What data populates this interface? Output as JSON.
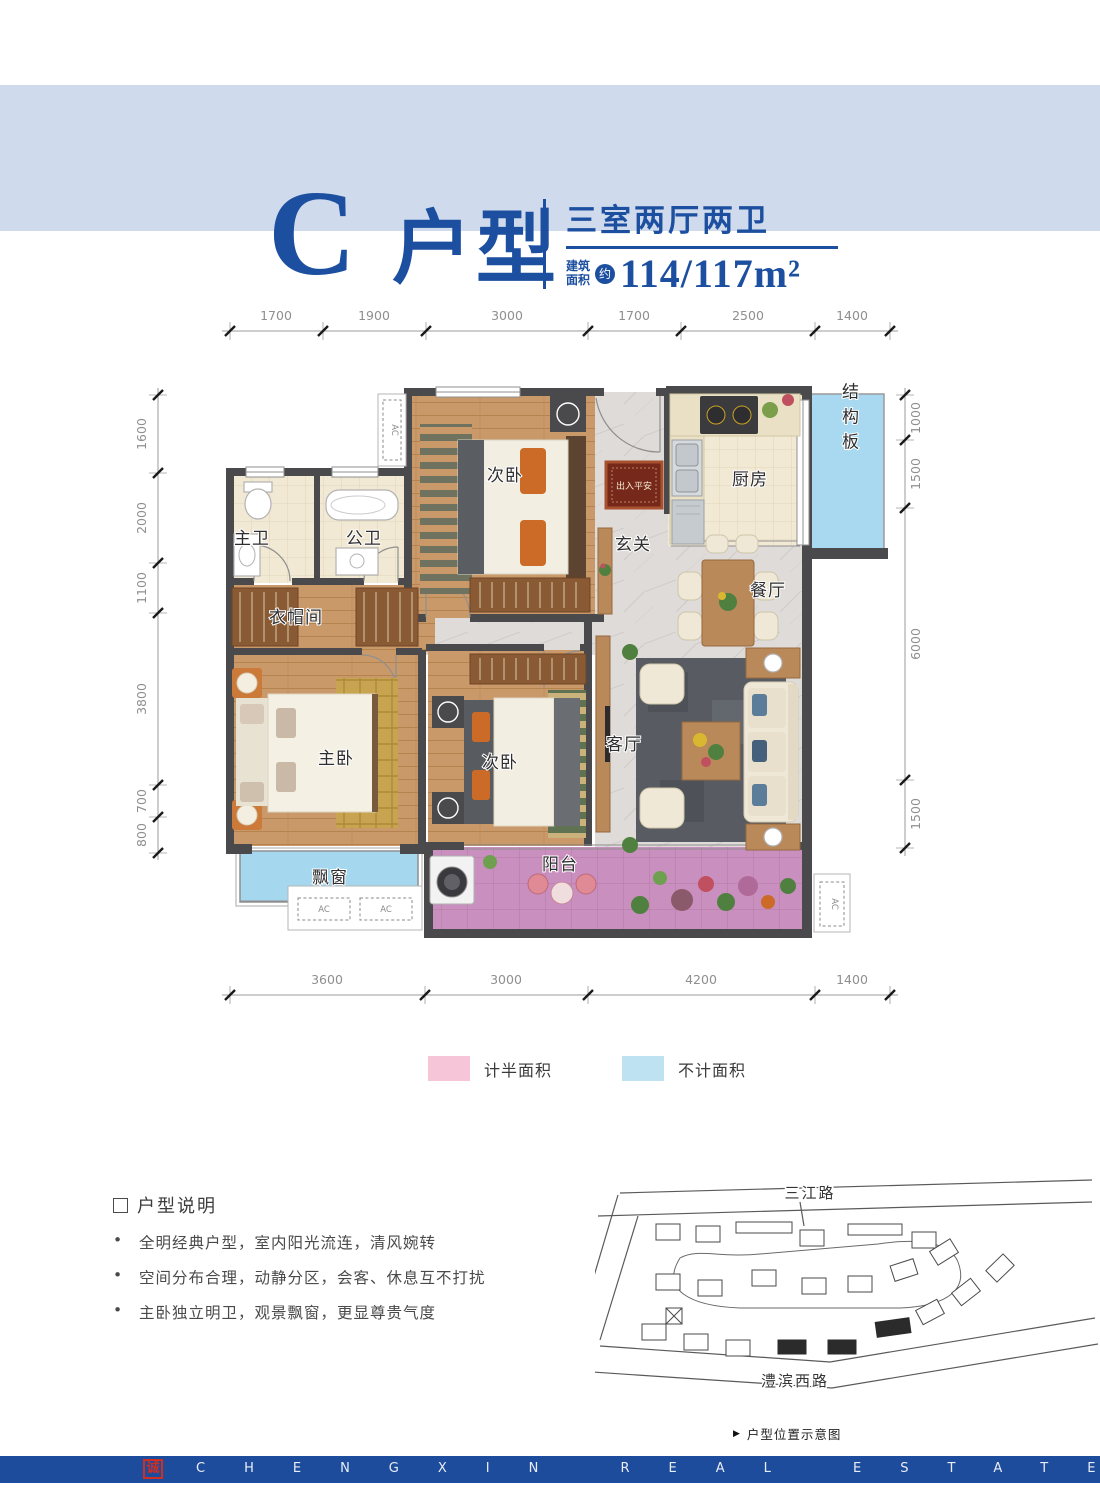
{
  "header": {
    "type_letter": "C",
    "type_name": "户型",
    "rooms_title": "三室两厅两卫",
    "area_label_line1": "建筑",
    "area_label_line2": "面积",
    "area_approx": "约",
    "area_value": "114/117m²"
  },
  "dimensions": {
    "top": [
      "1700",
      "1900",
      "3000",
      "1700",
      "2500",
      "1400"
    ],
    "left": [
      "1600",
      "2000",
      "1100",
      "3800",
      "700",
      "800"
    ],
    "right": [
      "1000",
      "1500",
      "6000",
      "1500"
    ],
    "bottom": [
      "3600",
      "3000",
      "4200",
      "1400"
    ]
  },
  "rooms": {
    "bedroom_top": "次卧",
    "entry_hall": "玄关",
    "kitchen": "厨房",
    "structure_board": "结构板",
    "master_bath": "主卫",
    "shared_bath": "公卫",
    "cloakroom": "衣帽间",
    "master_bedroom": "主卧",
    "second_bedroom": "次卧",
    "living_room": "客厅",
    "dining_room": "餐厅",
    "bay_window": "飘窗",
    "balcony": "阳台",
    "doormat": "出入平安",
    "ac_unit": "AC"
  },
  "legend": {
    "half_area": {
      "label": "计半面积",
      "color": "#f6c6d8"
    },
    "excluded_area": {
      "label": "不计面积",
      "color": "#bfe2f2"
    }
  },
  "description": {
    "title": "户型说明",
    "bullets": [
      "全明经典户型，室内阳光流连，清风婉转",
      "空间分布合理，动静分区，会客、休息互不打扰",
      "主卧独立明卫，观景飘窗，更显尊贵气度"
    ]
  },
  "sitemap": {
    "road_top": "三江路",
    "road_bottom": "澧滨西路",
    "caption": "户型位置示意图"
  },
  "footer": {
    "brand": "CHENGXIN REAL ESTATE",
    "seal": "诚"
  },
  "colors": {
    "accent_blue": "#1c4fa0",
    "band_blue": "#cfdbec",
    "footer_blue": "#1e4c9c",
    "balcony_pink": "#ca8fbf",
    "bay_window_blue": "#a5d7ee",
    "structure_blue": "#a8d9f0",
    "legend_pink": "#f6c6d8",
    "legend_blue": "#bfe2f2"
  }
}
